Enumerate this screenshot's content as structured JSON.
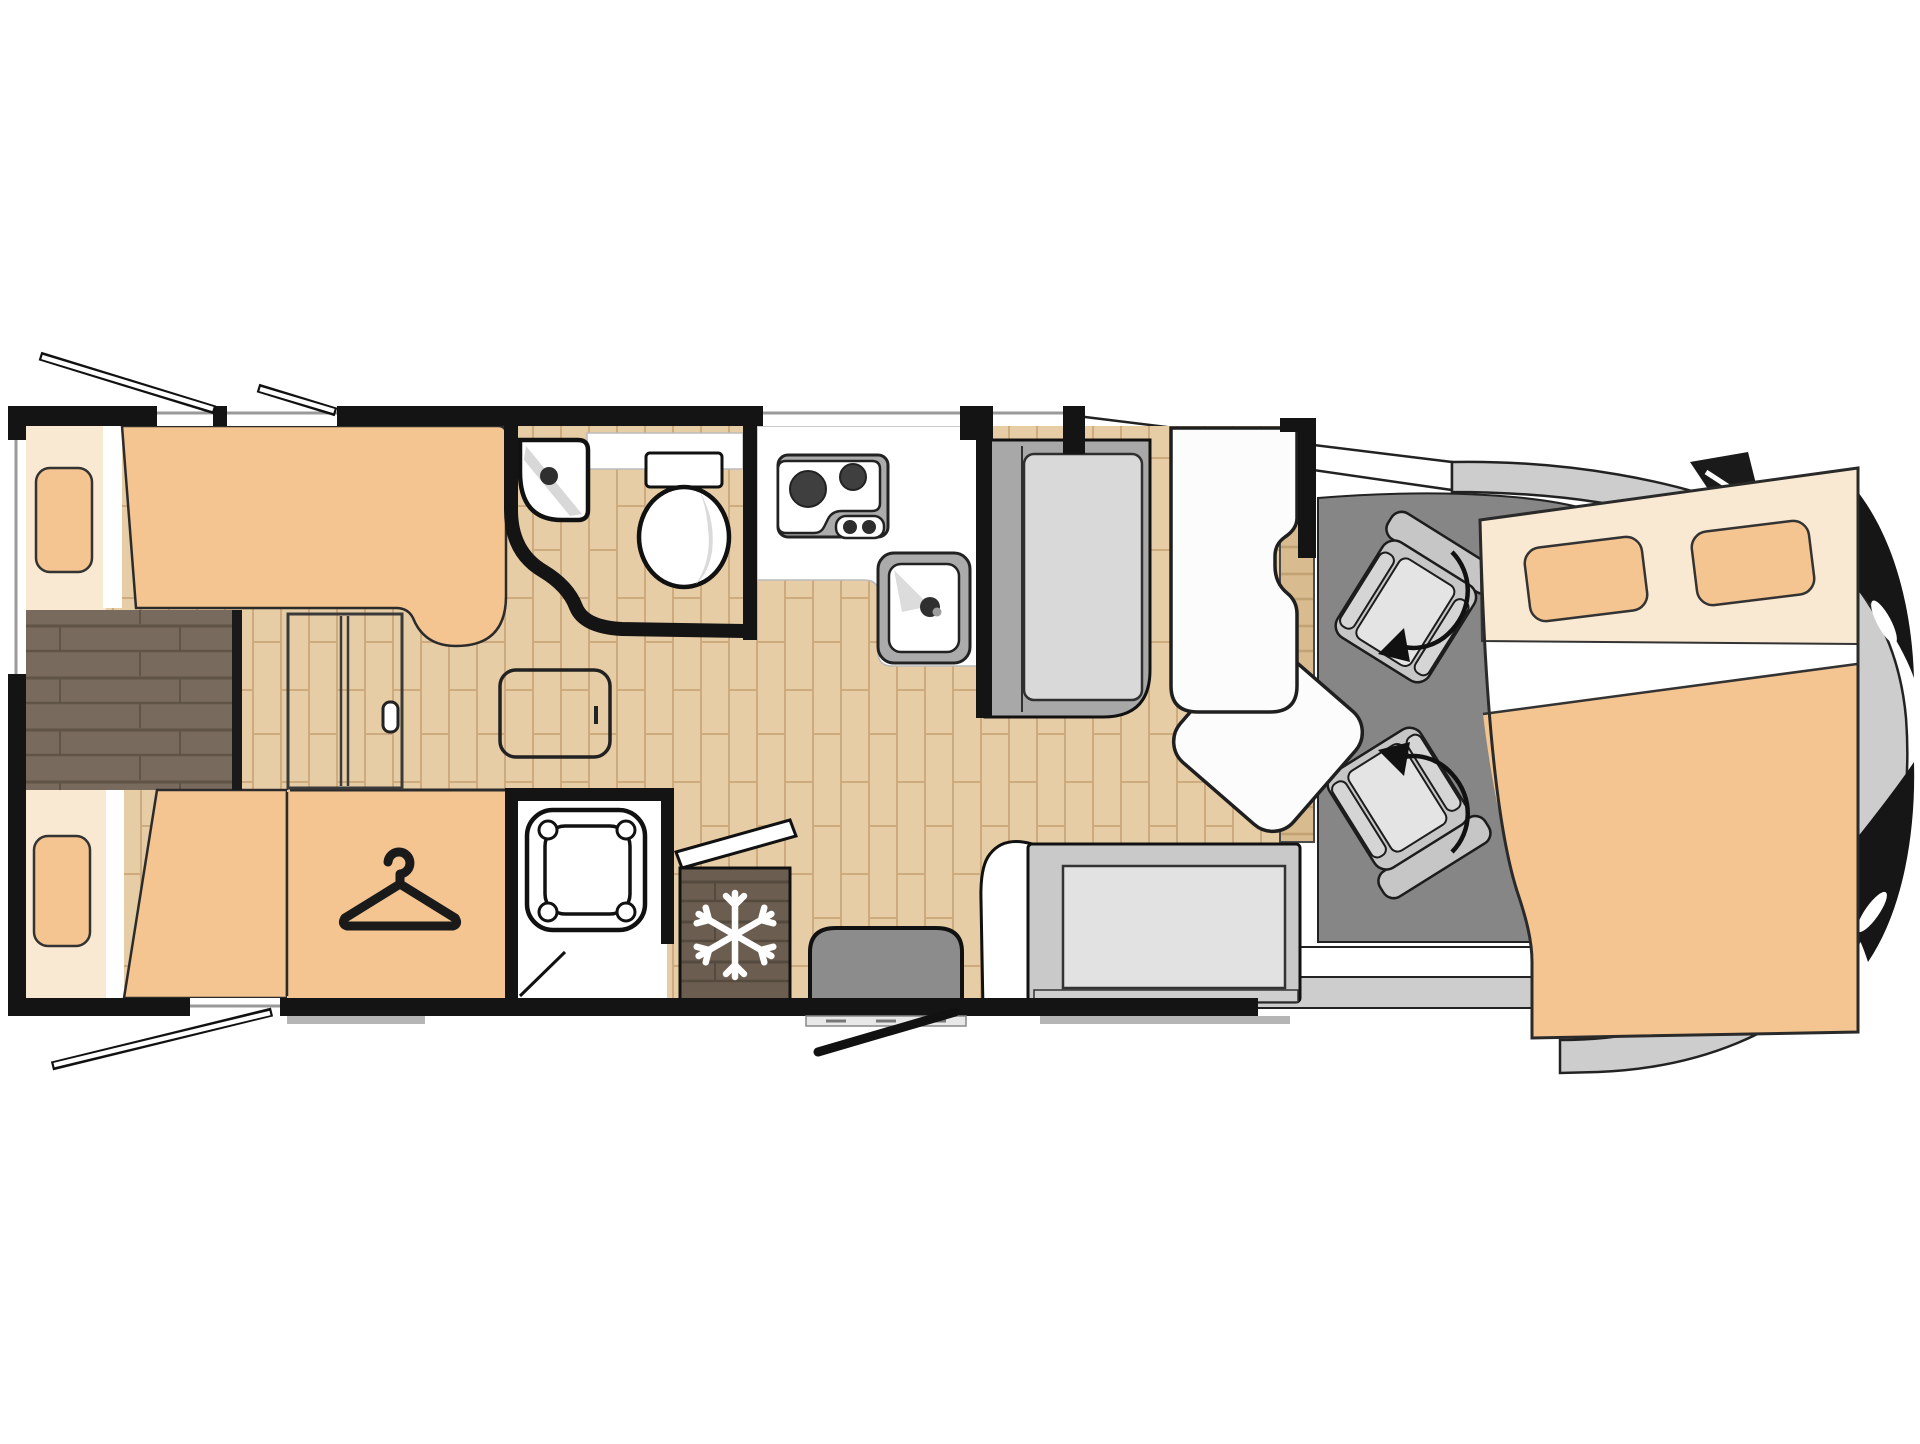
{
  "page": {
    "type": "motorhome-floor-plan",
    "background": "#ffffff",
    "vehicle_front_side": "right",
    "visible_text": ""
  },
  "colors": {
    "wall": "#141414",
    "outline": "#1c1c1c",
    "white": "#ffffff",
    "floor_light_wood": "#e6cda6",
    "floor_light_wood_line": "#cdab7e",
    "walkway_dark_wood": "#786a5c",
    "walkway_dark_wood_line": "#605447",
    "fridge_wood": "#6b5e51",
    "fridge_wood_line": "#554a3e",
    "sideboard_wood": "#d9bb90",
    "sideboard_wood_line": "#c1a273",
    "bed_peach": "#f4c491",
    "bed_cream": "#f9e9d2",
    "cab_floor": "#868686",
    "vehicle_body": "#cdcdcd",
    "seat_frame": "#c6c6c6",
    "seat_cushion": "#e4e4e4",
    "bench_frame": "#a8a8a8",
    "bench_cushion": "#d9d9d9",
    "bench2_frame": "#c9c9c9",
    "bench2_cushion": "#e2e2e2",
    "entry_mat": "#8c8c8c",
    "appliance_gray": "#ababab",
    "table_white": "#fcfcfc"
  },
  "features": [
    {
      "id": "rear-bed-upper",
      "kind": "single bed with pillow"
    },
    {
      "id": "rear-bed-lower",
      "kind": "single bed with pillow"
    },
    {
      "id": "rear-walkway",
      "kind": "dark wood step between twin beds"
    },
    {
      "id": "wardrobe",
      "kind": "wardrobe marked with hanger icon"
    },
    {
      "id": "sliding-door",
      "kind": "sliding partition door with handle"
    },
    {
      "id": "side-table",
      "kind": "small table in corridor"
    },
    {
      "id": "washroom",
      "kind": "washroom with corner basin and toilet"
    },
    {
      "id": "kitchen",
      "kind": "kitchen block with two-burner hob and sink"
    },
    {
      "id": "shower",
      "kind": "separate shower cubicle"
    },
    {
      "id": "fridge",
      "kind": "refrigerator marked with snowflake icon"
    },
    {
      "id": "entry-door",
      "kind": "entrance door with step mat, shown open"
    },
    {
      "id": "travel-bench",
      "kind": "forward travel bench seat"
    },
    {
      "id": "side-bench",
      "kind": "side bench seat at entrance"
    },
    {
      "id": "lounge-table",
      "kind": "white pedestal table with swivelled leaf"
    },
    {
      "id": "sideboard",
      "kind": "wooden sideboard strip"
    },
    {
      "id": "driver-seat",
      "kind": "swivelling cab seat with rotation arrow"
    },
    {
      "id": "passenger-seat",
      "kind": "swivelling cab seat with rotation arrow"
    },
    {
      "id": "drop-down-bed",
      "kind": "double overcab bed with two pillows"
    },
    {
      "id": "windows",
      "kind": "wall windows, three shown open as awning flaps"
    }
  ],
  "icons": [
    "hanger-icon",
    "snowflake-icon",
    "rotate-arrow-icon",
    "hob-burner-icon",
    "faucet-icon",
    "door-handle-icon"
  ]
}
